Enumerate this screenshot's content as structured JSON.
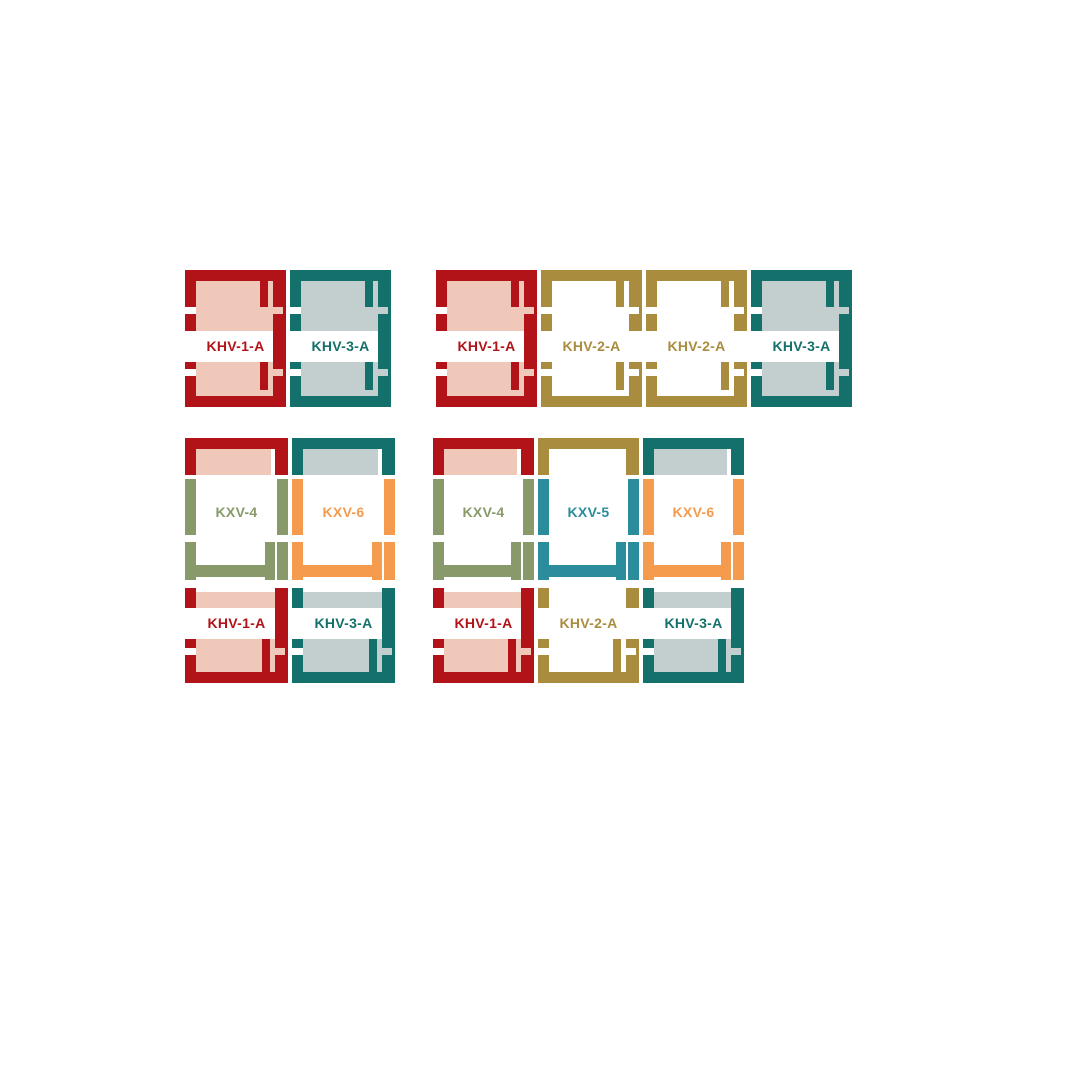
{
  "page": {
    "width": 1066,
    "height": 1066,
    "background": "#ffffff"
  },
  "palette": {
    "red": "#b11318",
    "pink": "#f0c8b9",
    "teal": "#14706a",
    "gray_blue": "#c3cfcf",
    "gold": "#a98c3e",
    "olive": "#889a69",
    "orange": "#f49b4d",
    "blue": "#2b8c9b",
    "white": "#ffffff"
  },
  "kits": {
    "KHV-1-A": {
      "frame": "red",
      "fill": "pink",
      "right_bar_continuous": true
    },
    "KHV-2-A": {
      "frame": "gold",
      "fill": "white",
      "right_bar_continuous": false
    },
    "KHV-3-A": {
      "frame": "teal",
      "fill": "gray_blue",
      "right_bar_continuous": true
    },
    "KXV-4": {
      "frame": "olive"
    },
    "KXV-5": {
      "frame": "blue"
    },
    "KXV-6": {
      "frame": "orange"
    }
  },
  "groups": [
    {
      "name": "flashing-combination-1x2",
      "x": 185,
      "y": 270,
      "unit_width": 101,
      "gap": 4,
      "units": [
        {
          "label": "KHV-1-A"
        },
        {
          "label": "KHV-3-A"
        }
      ]
    },
    {
      "name": "flashing-combination-1x4",
      "x": 436,
      "y": 270,
      "unit_width": 101,
      "gap": 4,
      "units": [
        {
          "label": "KHV-1-A"
        },
        {
          "label": "KHV-2-A"
        },
        {
          "label": "KHV-2-A"
        },
        {
          "label": "KHV-3-A"
        }
      ]
    },
    {
      "name": "flashing-combination-2x2",
      "x": 185,
      "y": 438,
      "unit_width": 103,
      "gap": 4,
      "columns": [
        {
          "top": "KXV-4",
          "bottom": "KHV-1-A"
        },
        {
          "top": "KXV-6",
          "bottom": "KHV-3-A"
        }
      ]
    },
    {
      "name": "flashing-combination-2x3",
      "x": 433,
      "y": 438,
      "unit_width": 101,
      "gap": 4,
      "columns": [
        {
          "top": "KXV-4",
          "bottom": "KHV-1-A"
        },
        {
          "top": "KXV-5",
          "bottom": "KHV-2-A"
        },
        {
          "top": "KXV-6",
          "bottom": "KHV-3-A"
        }
      ]
    }
  ]
}
